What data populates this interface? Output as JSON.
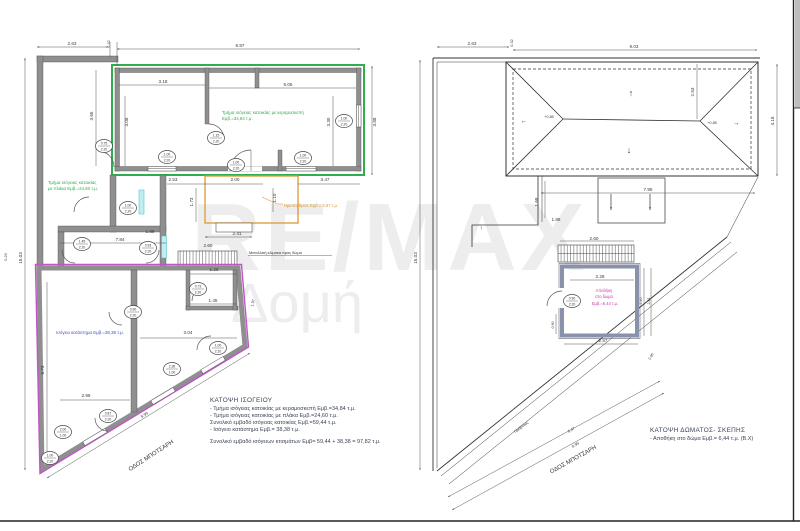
{
  "watermark": {
    "line1": "RE/MAX",
    "line2": "Δομή"
  },
  "colors": {
    "wall_gray": "#8f8f8f",
    "house_green": "#2fae4e",
    "shop_magenta": "#c054c8",
    "semi_open_orange": "#dd9833",
    "shop_label_blue": "#4452c8",
    "storage_magenta": "#cb3fae",
    "dim_text": "#3b3b3b"
  },
  "left_plan": {
    "title": "ΚΑΤΟΨΗ ΙΣΟΓΕΙΟΥ",
    "notes": [
      "- Τμήμα ισόγειας κατοικίας με κεραμοσκεπή Εμβ.=34,84 τ.μ.",
      "- Τμήμα ισόγειας κατοικίας με πλάκα Εμβ.=24,60 τ.μ.",
      "Συνολικό εμβαδό ισόγειας κατοικίας Εμβ.=59,44 τ.μ.",
      "- Ισόγειο κατάστημα Εμβ.= 38,38 τ.μ."
    ],
    "total": "Συνολικό εμβαδό ισόγειων κτισμάτων Εμβ= 59,44 + 38,38 = 97,82 τ.μ.",
    "area_labels": [
      {
        "t": "Τμήμα ισόγειας κατοικίας με κεραμοσκεπή",
        "x": 222,
        "y": 114,
        "a": "start",
        "c": "#2fae4e",
        "s": 4.4,
        "n": "tile-roof-section-label"
      },
      {
        "t": "Εμβ.=34,84 τ.μ.",
        "x": 222,
        "y": 120,
        "a": "start",
        "c": "#2fae4e",
        "s": 4.4,
        "n": "tile-roof-area-label"
      },
      {
        "t": "Τμήμα ισόγειας κατοικίας",
        "x": 48,
        "y": 184,
        "a": "start",
        "c": "#2fae4e",
        "s": 4.4,
        "n": "slab-section-label"
      },
      {
        "t": "με πλάκα Εμβ.=24,60 τ.μ.",
        "x": 48,
        "y": 190,
        "a": "start",
        "c": "#2fae4e",
        "s": 4.4,
        "n": "slab-area-label"
      },
      {
        "t": "Ισόγειο κατάστημα Εμβ.=38,38 τ.μ.",
        "x": 56,
        "y": 334,
        "a": "start",
        "c": "#4452c8",
        "s": 4.4,
        "n": "shop-area-label"
      },
      {
        "t": "Ημιυπαίθριος Εμβ.= 3,97 τ.μ.",
        "x": 284,
        "y": 207,
        "a": "start",
        "c": "#dd9833",
        "s": 4.2,
        "n": "semi-open-area-label"
      },
      {
        "t": "Μεταλλική κλίμακα προς δώμα",
        "x": 249,
        "y": 254,
        "a": "start",
        "c": "#333333",
        "s": 3.9,
        "n": "stair-label"
      },
      {
        "t": "ΟΔΟΣ ΜΠΟΤΣΑΡΗ",
        "x": 152,
        "y": 457,
        "r": -33,
        "c": "#333333",
        "s": 6,
        "n": "street-label"
      }
    ],
    "dim_labels": [
      {
        "t": "2.63",
        "x": 72,
        "y": 45
      },
      {
        "t": "0.32",
        "x": 110,
        "y": 44,
        "r": -90,
        "s": 3.8
      },
      {
        "t": "8.87",
        "x": 240,
        "y": 47
      },
      {
        "t": "15.03",
        "x": 22,
        "y": 258,
        "r": -90
      },
      {
        "t": "0.20",
        "x": 7,
        "y": 257,
        "r": -90,
        "s": 3.8
      },
      {
        "t": "3.88",
        "x": 376,
        "y": 122,
        "r": -90
      },
      {
        "t": "3.18",
        "x": 163,
        "y": 83
      },
      {
        "t": "5.05",
        "x": 288,
        "y": 86
      },
      {
        "t": "3.65",
        "x": 93,
        "y": 116,
        "r": -90
      },
      {
        "t": "3.08",
        "x": 128,
        "y": 122,
        "r": -90
      },
      {
        "t": "3.30",
        "x": 330,
        "y": 122,
        "r": -90
      },
      {
        "t": "2.53",
        "x": 173,
        "y": 181
      },
      {
        "t": "2.00",
        "x": 235,
        "y": 181
      },
      {
        "t": "3.47",
        "x": 325,
        "y": 181
      },
      {
        "t": "1.73",
        "x": 193,
        "y": 202,
        "r": -90
      },
      {
        "t": "1.10",
        "x": 276,
        "y": 198,
        "r": -90
      },
      {
        "t": "7.84",
        "x": 120,
        "y": 241
      },
      {
        "t": "1.88",
        "x": 150,
        "y": 233
      },
      {
        "t": "2.60",
        "x": 208,
        "y": 247
      },
      {
        "t": "2.41",
        "x": 237,
        "y": 235
      },
      {
        "t": "1.26",
        "x": 214,
        "y": 271
      },
      {
        "t": "1.45",
        "x": 213,
        "y": 302
      },
      {
        "t": "3.04",
        "x": 188,
        "y": 334
      },
      {
        "t": "2.99",
        "x": 86,
        "y": 397
      },
      {
        "t": "6.73",
        "x": 44,
        "y": 370,
        "r": -90
      },
      {
        "t": "1.97",
        "x": 254,
        "y": 303,
        "r": -78,
        "s": 3.8
      },
      {
        "t": "8.99",
        "x": 145,
        "y": 416,
        "r": -31,
        "s": 3.9
      }
    ],
    "door_tags": [
      {
        "x": 104,
        "y": 146,
        "a": "0.75",
        "b": "2.20"
      },
      {
        "x": 167,
        "y": 157,
        "a": "1.00",
        "b": "2.20"
      },
      {
        "x": 216,
        "y": 138,
        "a": "1.15",
        "b": "2.20"
      },
      {
        "x": 236,
        "y": 165,
        "a": "1.00",
        "b": "2.20"
      },
      {
        "x": 303,
        "y": 158,
        "a": "1.00",
        "b": "2.20"
      },
      {
        "x": 344,
        "y": 121,
        "a": "1.00",
        "b": "2.20"
      },
      {
        "x": 128,
        "y": 208,
        "a": "1.00",
        "b": "2.20"
      },
      {
        "x": 82,
        "y": 244,
        "a": "1.45",
        "b": "2.20"
      },
      {
        "x": 148,
        "y": 248,
        "a": "0.93",
        "b": "2.20"
      },
      {
        "x": 198,
        "y": 289,
        "a": "0.73",
        "b": "2.20"
      },
      {
        "x": 133,
        "y": 312,
        "a": "0.90",
        "b": "2.20"
      },
      {
        "x": 218,
        "y": 348,
        "a": "1.00",
        "b": "2.20"
      },
      {
        "x": 172,
        "y": 369,
        "a": "2.36",
        "b": "1.00"
      },
      {
        "x": 108,
        "y": 416,
        "a": "0.87",
        "b": "2.20"
      },
      {
        "x": 63,
        "y": 432,
        "a": "2.00",
        "b": "1.00"
      },
      {
        "x": 50,
        "y": 458,
        "a": "1.00",
        "b": "2.20"
      }
    ]
  },
  "right_plan": {
    "title": "ΚΑΤΟΨΗ ΔΩΜΑΤΟΣ- ΣΚΕΠΗΣ",
    "note": "- Αποθήκη στο δώμα Εμβ.= 6,44 τ.μ. (Β.Χ)",
    "area_labels": [
      {
        "t": "Αποθήκη",
        "x": 604,
        "y": 292,
        "c": "#cb3fae",
        "s": 4.1,
        "n": "roof-storage-label"
      },
      {
        "t": "στο δώμα",
        "x": 604,
        "y": 298,
        "c": "#cb3fae",
        "s": 4.1,
        "n": "roof-storage-label"
      },
      {
        "t": "Εμβ.=6,44 τ.μ.",
        "x": 605,
        "y": 305,
        "c": "#cb3fae",
        "s": 4.1,
        "n": "roof-storage-area-label"
      },
      {
        "t": "Πρόβολος",
        "x": 522,
        "y": 428,
        "r": -37,
        "c": "#333333",
        "s": 3.8,
        "n": "cantilever-label"
      },
      {
        "t": "ΟΔΟΣ ΜΠΟΤΣΑΡΗ",
        "x": 574,
        "y": 461,
        "r": -29,
        "c": "#333333",
        "s": 6,
        "n": "street-label"
      }
    ],
    "dim_labels": [
      {
        "t": "2.63",
        "x": 472,
        "y": 45
      },
      {
        "t": "0.32",
        "x": 513,
        "y": 43,
        "r": -90,
        "s": 3.8
      },
      {
        "t": "9.03",
        "x": 634,
        "y": 48
      },
      {
        "t": "15.03",
        "x": 417,
        "y": 258,
        "r": -90
      },
      {
        "t": "2.53",
        "x": 694,
        "y": 92,
        "r": -90
      },
      {
        "t": "4.18",
        "x": 774,
        "y": 121,
        "r": -90
      },
      {
        "t": "+0,85",
        "x": 549,
        "y": 118,
        "s": 3.8
      },
      {
        "t": "+0,85",
        "x": 712,
        "y": 124,
        "s": 3.8
      },
      {
        "t": "7.95",
        "x": 648,
        "y": 191
      },
      {
        "t": "1.68",
        "x": 538,
        "y": 202,
        "r": -90
      },
      {
        "t": "1.88",
        "x": 556,
        "y": 221
      },
      {
        "t": "2.60",
        "x": 594,
        "y": 240
      },
      {
        "t": "2.28",
        "x": 600,
        "y": 278
      },
      {
        "t": "2.57",
        "x": 603,
        "y": 342
      },
      {
        "t": "2.40",
        "x": 642,
        "y": 301,
        "r": -90,
        "s": 3.6
      },
      {
        "t": "2.81",
        "x": 650,
        "y": 301,
        "r": -90,
        "s": 3.6
      },
      {
        "t": "0.90",
        "x": 554,
        "y": 325,
        "r": -90,
        "s": 3.6
      },
      {
        "t": "0.96",
        "x": 652,
        "y": 357,
        "r": -60,
        "s": 3.6
      },
      {
        "t": "6.47",
        "x": 572,
        "y": 431,
        "r": -29,
        "s": 3.9
      },
      {
        "t": "8.99",
        "x": 576,
        "y": 446,
        "r": -29,
        "s": 3.9
      },
      {
        "t": "↑",
        "x": 631,
        "y": 96,
        "s": 9
      },
      {
        "t": "↓",
        "x": 629,
        "y": 153,
        "s": 9
      },
      {
        "t": "←",
        "x": 524,
        "y": 123,
        "s": 7
      },
      {
        "t": "→",
        "x": 736,
        "y": 125,
        "s": 7
      },
      {
        "t": "↑",
        "x": 481,
        "y": 230,
        "s": 6
      }
    ],
    "door_tags": [
      {
        "x": 572,
        "y": 301,
        "a": "0.90",
        "b": "2.20"
      }
    ]
  }
}
